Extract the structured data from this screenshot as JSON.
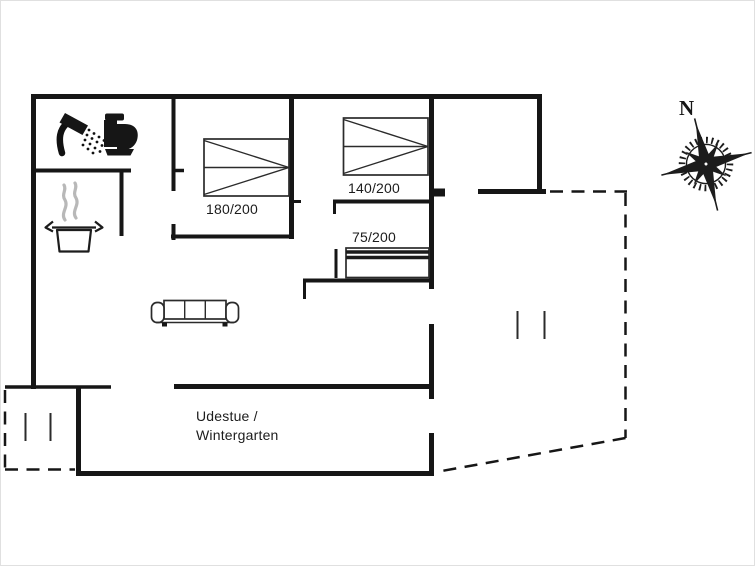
{
  "title": "Holiday house floor plan",
  "compass": {
    "north_label": "N"
  },
  "beds": [
    {
      "name": "double-bed-180x200",
      "label": "180/200"
    },
    {
      "name": "double-bed-140x200",
      "label": "140/200"
    },
    {
      "name": "single-bed-75x200",
      "label": "75/200"
    }
  ],
  "rooms": {
    "conservatory": {
      "label_line1": "Udestue /",
      "label_line2": "Wintergarten"
    }
  },
  "icons": {
    "shower": "shower-icon",
    "toilet": "toilet-icon",
    "cooking_pot": "cooking-pot-icon",
    "steam": "steam-icon",
    "sofa": "sofa-icon",
    "compass_rose": "compass-rose-icon"
  },
  "colors": {
    "walls": "#161616",
    "furniture_lines": "#2b2b2b",
    "steam": "#b8b8b8",
    "background": "#ffffff"
  }
}
